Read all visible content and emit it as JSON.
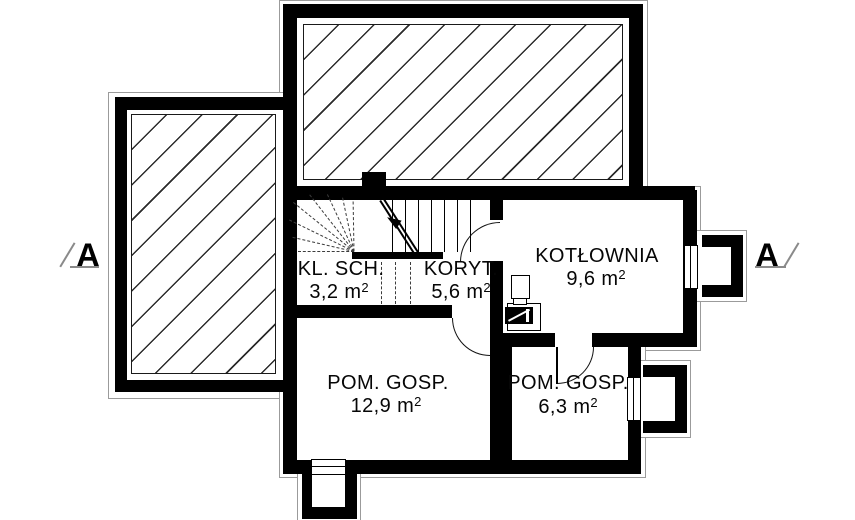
{
  "plan": {
    "rooms": [
      {
        "name": "KL. SCH.",
        "area": "3,2 m",
        "area_sup": "2"
      },
      {
        "name": "KORYT.",
        "area": "5,6 m",
        "area_sup": "2"
      },
      {
        "name": "KOTŁOWNIA",
        "area": "9,6 m",
        "area_sup": "2"
      },
      {
        "name": "POM. GOSP.",
        "area": "12,9 m",
        "area_sup": "2"
      },
      {
        "name": "POM. GOSP.",
        "area": "6,3 m",
        "area_sup": "2"
      }
    ],
    "section_markers": {
      "left": "A",
      "right": "A"
    },
    "colors": {
      "wall": "#000000",
      "hatch_line": "#2b2b2b",
      "outline": "#9b9b9b",
      "background": "#ffffff"
    }
  }
}
